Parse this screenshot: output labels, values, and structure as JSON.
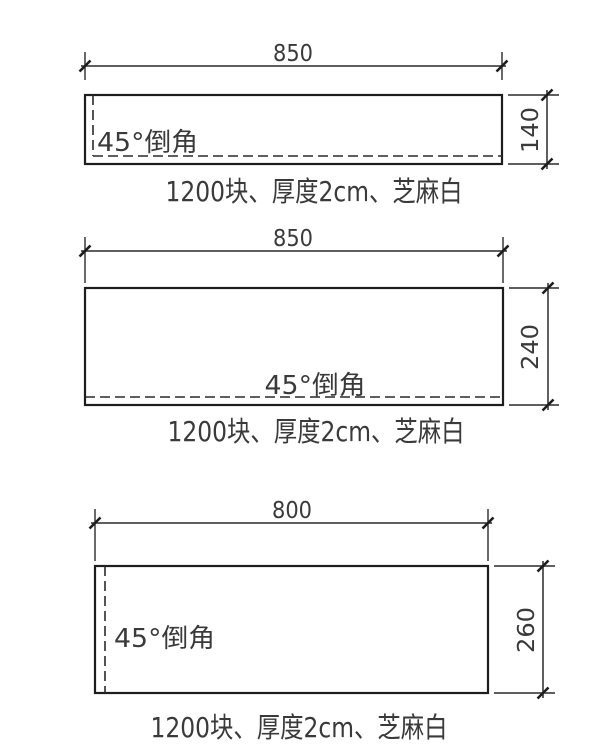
{
  "colors": {
    "background": "#ffffff",
    "line": "#1d1d1d",
    "text": "#3a3a3a"
  },
  "panels": [
    {
      "width_label": "850",
      "height_label": "140",
      "chamfer_label": "45°倒角",
      "caption": "1200块、厚度2cm、芝麻白"
    },
    {
      "width_label": "850",
      "height_label": "240",
      "chamfer_label": "45°倒角",
      "caption": "1200块、厚度2cm、芝麻白"
    },
    {
      "width_label": "800",
      "height_label": "260",
      "chamfer_label": "45°倒角",
      "caption": "1200块、厚度2cm、芝麻白"
    }
  ]
}
